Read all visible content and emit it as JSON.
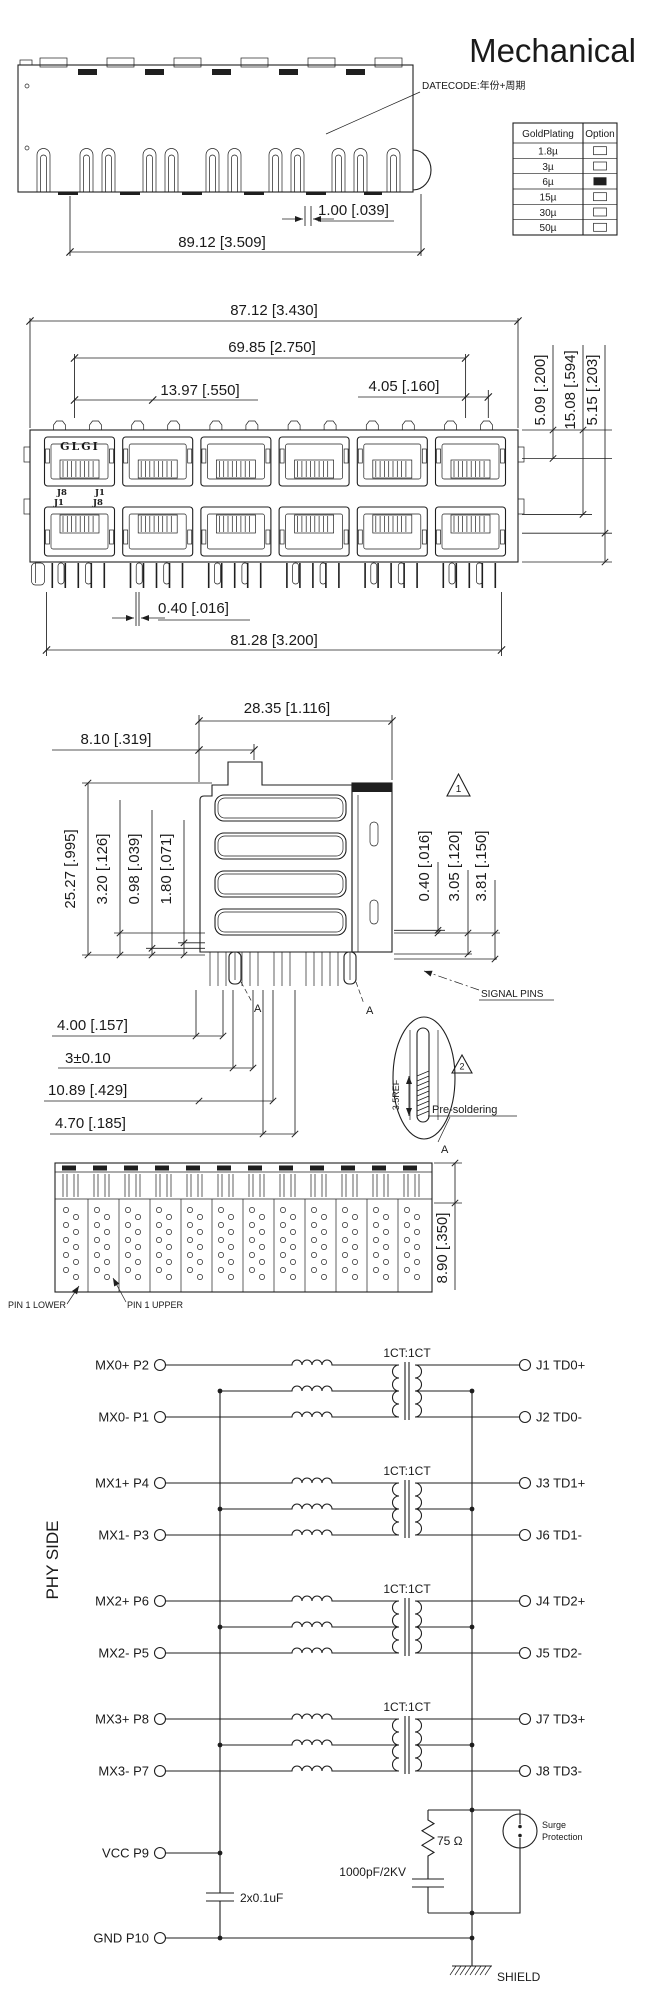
{
  "title": "Mechanical",
  "notes": {
    "datecode": "DATECODE:年份+周期"
  },
  "gold_table": {
    "col1": "GoldPlating",
    "col2": "Option",
    "rows": [
      {
        "label": "1.8µ",
        "selected": false
      },
      {
        "label": "3µ",
        "selected": false
      },
      {
        "label": "6µ",
        "selected": true
      },
      {
        "label": "15µ",
        "selected": false
      },
      {
        "label": "30µ",
        "selected": false
      },
      {
        "label": "50µ",
        "selected": false
      }
    ]
  },
  "top_view": {
    "dim_tab": "1.00 [.039]",
    "dim_width": "89.12 [3.509]"
  },
  "front_view": {
    "brand": "GLGI",
    "upper_left_pin": "J8",
    "upper_right_pin": "J1",
    "lower_left_pin": "J1",
    "lower_right_pin": "J8",
    "dim_overall_width": "87.12 [3.430]",
    "dim_port_span": "69.85 [2.750]",
    "dim_port_pitch": "13.97 [.550]",
    "dim_tab_offset": "4.05 [.160]",
    "dim_r1": "5.09 [.200]",
    "dim_r2": "15.08 [.594]",
    "dim_r3": "5.15 [.203]",
    "dim_pin_gap": "0.40 [.016]",
    "dim_pin_span": "81.28 [3.200]"
  },
  "side_view": {
    "dim_depth": "28.35 [1.116]",
    "dim_latch": "8.10 [.319]",
    "dim_h1": "25.27 [.995]",
    "dim_h2": "3.20 [.126]",
    "dim_h3": "0.98 [.039]",
    "dim_h4": "1.80 [.071]",
    "dim_r1": "0.40 [.016]",
    "dim_r2": "3.05 [.120]",
    "dim_r3": "3.81 [.150]",
    "dim_b1": "4.00 [.157]",
    "dim_b2": "3±0.10",
    "dim_b3": "10.89 [.429]",
    "dim_b4": "4.70 [.185]",
    "signal_pins": "SIGNAL PINS",
    "warn1": "1",
    "warn2": "2",
    "detail_ref": "3.5REF",
    "detail_label": "Pre-soldering",
    "section_a1": "A",
    "section_a2": "A",
    "section_a3": "A"
  },
  "bottom_view": {
    "dim_height": "8.90 [.350]",
    "pin1_lower": "PIN 1 LOWER",
    "pin1_upper": "PIN 1 UPPER"
  },
  "schematic": {
    "side_label": "PHY SIDE",
    "ratio_label": "1CT:1CT",
    "groups": [
      {
        "in_p": "MX0+ P2",
        "in_n": "MX0- P1",
        "out_p": "J1 TD0+",
        "out_n": "J2 TD0-"
      },
      {
        "in_p": "MX1+ P4",
        "in_n": "MX1- P3",
        "out_p": "J3 TD1+",
        "out_n": "J6 TD1-"
      },
      {
        "in_p": "MX2+ P6",
        "in_n": "MX2- P5",
        "out_p": "J4 TD2+",
        "out_n": "J5 TD2-"
      },
      {
        "in_p": "MX3+ P8",
        "in_n": "MX3- P7",
        "out_p": "J7 TD3+",
        "out_n": "J8 TD3-"
      }
    ],
    "vcc": "VCC P9",
    "gnd": "GND P10",
    "bypass_cap": "2x0.1uF",
    "resistor": "75 Ω",
    "hv_cap": "1000pF/2KV",
    "surge_line1": "Surge",
    "surge_line2": "Protection",
    "shield": "SHIELD"
  }
}
